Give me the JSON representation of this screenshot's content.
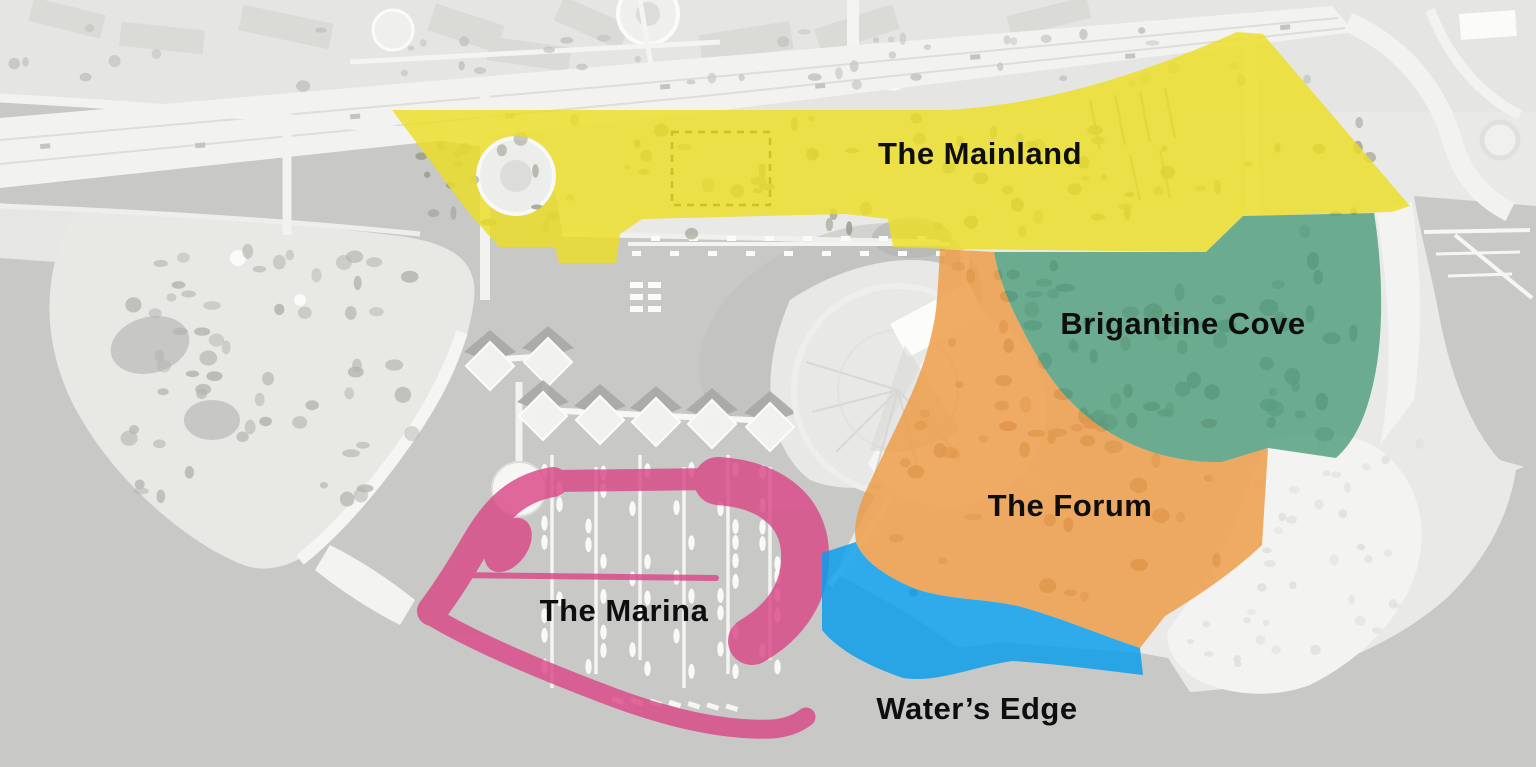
{
  "map": {
    "regions": [
      {
        "id": "mainland",
        "label": "The Mainland",
        "color": "#ecde23"
      },
      {
        "id": "brigantine-cove",
        "label": "Brigantine Cove",
        "color": "#4f9e7c"
      },
      {
        "id": "forum",
        "label": "The Forum",
        "color": "#ee9a43"
      },
      {
        "id": "marina",
        "label": "The Marina",
        "color": "#da4887"
      },
      {
        "id": "waters-edge",
        "label": "Water’s Edge",
        "color": "#069deb"
      }
    ],
    "label_color": "#0e0e0e",
    "basemap": {
      "water_color": "#c8c8c7",
      "land_color": "#e9e9e7",
      "shore_color": "#f3f3f1"
    }
  }
}
